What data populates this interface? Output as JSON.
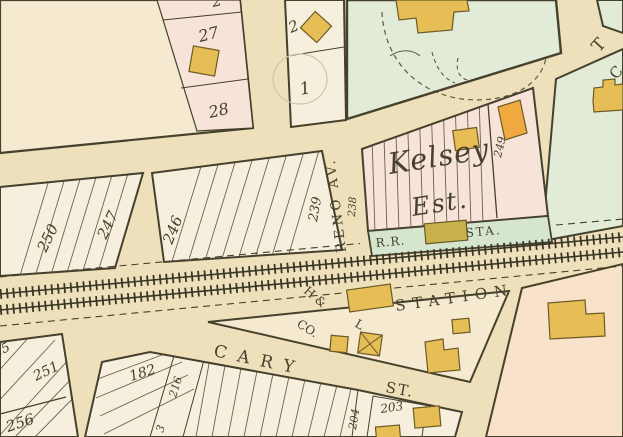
{
  "palette": {
    "paper": "#eee0ba",
    "cream": "#f5e9d0",
    "white": "#f6efdd",
    "pink": "#f7e3d8",
    "pinkwarm": "#f8e2c9",
    "green": "#e2ebd7",
    "greenstrip": "#d6e5ce",
    "yellow": "#e6be55",
    "orange": "#f0a93e",
    "olive": "#c8b14a",
    "ink": "#45412d",
    "rail": "#393627",
    "faint": "#d2c5a8"
  },
  "labels": {
    "partial_lot_top": "2",
    "lot_2": "2",
    "lot_1": "1",
    "lot_27": "27",
    "lot_28": "28",
    "lot_250": "250",
    "lot_247": "247",
    "lot_246": "246",
    "lot_239": "239",
    "lot_238": "238",
    "lot_249": "249",
    "lot_25x_partial": "25",
    "lot_251": "251",
    "lot_256": "256",
    "lot_182": "182",
    "lot_216": "216",
    "lot_213_partial": "3",
    "lot_203": "203",
    "lot_204": "204",
    "estate_line1": "Kelsey",
    "estate_line2": "Est.",
    "rr_abbr": "R.R.",
    "sta_abbr": "STA.",
    "station": "STATION",
    "hl_co_1": "H &",
    "hl_co_2": "L",
    "hl_co_3": "CO.",
    "street_reno": "RENO AV.",
    "street_cary": "CARY",
    "street_cary_st": "ST.",
    "street_t_partial": "T",
    "street_c_partial": "C"
  }
}
